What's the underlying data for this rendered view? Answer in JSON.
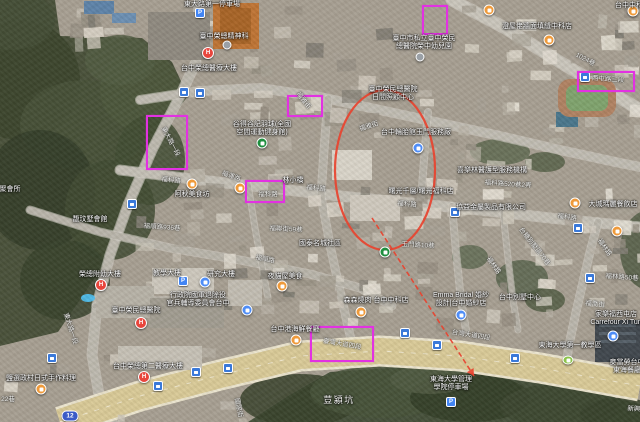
{
  "colors": {
    "annotation_magenta": "#e231e2",
    "route_red": "#e8432f",
    "label_white": "#ffffff",
    "boulevard_tan": "#d9ca97"
  },
  "route_shield": {
    "text": "12",
    "x": 70,
    "y": 416
  },
  "annotation_rects": [
    {
      "x": 146,
      "y": 115,
      "w": 42,
      "h": 55
    },
    {
      "x": 245,
      "y": 180,
      "w": 40,
      "h": 23
    },
    {
      "x": 422,
      "y": 5,
      "w": 26,
      "h": 30
    },
    {
      "x": 577,
      "y": 71,
      "w": 58,
      "h": 21
    },
    {
      "x": 287,
      "y": 95,
      "w": 36,
      "h": 22
    },
    {
      "x": 310,
      "y": 326,
      "w": 64,
      "h": 36
    }
  ],
  "route_annotation": {
    "ellipse": {
      "cx": 385,
      "cy": 170,
      "rx": 50,
      "ry": 80
    },
    "arrow_line": {
      "x1": 372,
      "y1": 218,
      "x2": 474,
      "y2": 376
    }
  },
  "labels": {
    "poi": [
      {
        "lines": [
          "東大路第一停車場"
        ],
        "x": 212,
        "y": 1
      },
      {
        "lines": [
          "臺中榮總精神科"
        ],
        "x": 224,
        "y": 33
      },
      {
        "lines": [
          "台中榮總醫療大樓"
        ],
        "x": 209,
        "y": 65
      },
      {
        "lines": [
          "臺中市私立臺中榮民",
          "總醫院榮中幼兒園"
        ],
        "x": 424,
        "y": 35
      },
      {
        "lines": [
          "臺中榮民總醫院",
          "日間照顧中心"
        ],
        "x": 393,
        "y": 86
      },
      {
        "lines": [
          "澄屋佬牆面填縫中科店"
        ],
        "x": 537,
        "y": 23
      },
      {
        "lines": [
          "台中中科"
        ],
        "x": 629,
        "y": 2
      },
      {
        "lines": [
          "台中輪胎館玉門服務廠"
        ],
        "x": 416,
        "y": 129
      },
      {
        "lines": [
          "谷得谷記羽球(全國",
          "空間運動健身館)"
        ],
        "x": 262,
        "y": 121
      },
      {
        "lines": [
          "喜樂林醫護型服務機構"
        ],
        "x": 492,
        "y": 167
      },
      {
        "lines": [
          "曙光千層/曙光福科店"
        ],
        "x": 421,
        "y": 188
      },
      {
        "lines": [
          "協益金屬製品有限公司"
        ],
        "x": 491,
        "y": 204
      },
      {
        "lines": [
          "大城瑪麗餐飲店"
        ],
        "x": 613,
        "y": 201
      },
      {
        "lines": [
          "阿秋美食坊"
        ],
        "x": 192,
        "y": 191
      },
      {
        "lines": [
          "林小橋"
        ],
        "x": 293,
        "y": 177
      },
      {
        "lines": [
          "馥玟墅會館"
        ],
        "x": 90,
        "y": 216
      },
      {
        "lines": [
          "聚會所"
        ],
        "x": 10,
        "y": 186
      },
      {
        "lines": [
          "國泰名城社區"
        ],
        "x": 320,
        "y": 240
      },
      {
        "lines": [
          "夜貓屋美食"
        ],
        "x": 285,
        "y": 273
      },
      {
        "lines": [
          "行政院國軍退除役",
          "官兵輔導委員會台中"
        ],
        "x": 198,
        "y": 292
      },
      {
        "lines": [
          "教學大樓"
        ],
        "x": 167,
        "y": 270
      },
      {
        "lines": [
          "研究大樓"
        ],
        "x": 221,
        "y": 271
      },
      {
        "lines": [
          "榮總附幼大樓"
        ],
        "x": 100,
        "y": 271
      },
      {
        "lines": [
          "臺中榮民總醫院"
        ],
        "x": 136,
        "y": 307
      },
      {
        "lines": [
          "台中榮總第二醫療大樓"
        ],
        "x": 148,
        "y": 363
      },
      {
        "lines": [
          "鹽選政村日式手作料理"
        ],
        "x": 41,
        "y": 375
      },
      {
        "lines": [
          "森森燒肉 台中中科店"
        ],
        "x": 376,
        "y": 297
      },
      {
        "lines": [
          "Emma Bridal 婚紗",
          "設計|台中婚紗店"
        ],
        "x": 461,
        "y": 292
      },
      {
        "lines": [
          "台中別墅中心"
        ],
        "x": 520,
        "y": 294
      },
      {
        "lines": [
          "台中港海鮮餐廳"
        ],
        "x": 295,
        "y": 326
      },
      {
        "lines": [
          "家樂福西屯店",
          "Carrefour Xi Tun"
        ],
        "x": 616,
        "y": 311
      },
      {
        "lines": [
          "麥當勞台中",
          "東海餐廳"
        ],
        "x": 627,
        "y": 359
      },
      {
        "lines": [
          "東海大學第一教學區"
        ],
        "x": 570,
        "y": 342
      },
      {
        "lines": [
          "東海大學管理",
          "學院停車場"
        ],
        "x": 451,
        "y": 376
      }
    ],
    "street": [
      {
        "text": "福雅街",
        "x": 369,
        "y": 123,
        "rot": -18
      },
      {
        "text": "福雅街",
        "x": 303,
        "y": 97,
        "rot": 52
      },
      {
        "text": "東大路一段",
        "x": 170,
        "y": 138,
        "rot": 62
      },
      {
        "text": "東大路一段",
        "x": 70,
        "y": 325,
        "rot": 72
      },
      {
        "text": "福科路",
        "x": 171,
        "y": 177,
        "rot": 6
      },
      {
        "text": "福科路",
        "x": 316,
        "y": 185,
        "rot": 6
      },
      {
        "text": "福科路",
        "x": 407,
        "y": 201,
        "rot": 5
      },
      {
        "text": "福科路",
        "x": 567,
        "y": 214,
        "rot": 8
      },
      {
        "text": "福科路",
        "x": 268,
        "y": 191,
        "rot": 0
      },
      {
        "text": "福科路520巷2弄",
        "x": 508,
        "y": 181,
        "rot": 4
      },
      {
        "text": "福運路",
        "x": 231,
        "y": 173,
        "rot": 20
      },
      {
        "text": "福順路936巷",
        "x": 162,
        "y": 224,
        "rot": 4
      },
      {
        "text": "福順路",
        "x": 265,
        "y": 256,
        "rot": 12
      },
      {
        "text": "福聯街59巷",
        "x": 286,
        "y": 226,
        "rot": 3
      },
      {
        "text": "玉門路10巷",
        "x": 418,
        "y": 242,
        "rot": 3
      },
      {
        "text": "福林路",
        "x": 493,
        "y": 262,
        "rot": 55
      },
      {
        "text": "台糖別墅區70巷",
        "x": 534,
        "y": 243,
        "rot": 52
      },
      {
        "text": "福林路",
        "x": 604,
        "y": 244,
        "rot": 55
      },
      {
        "text": "福林路50巷",
        "x": 622,
        "y": 274,
        "rot": 4
      },
      {
        "text": "福喬街",
        "x": 595,
        "y": 301,
        "rot": 6
      },
      {
        "text": "1024巷",
        "x": 585,
        "y": 56,
        "rot": 28
      },
      {
        "text": "西屯路三段",
        "x": 608,
        "y": 76,
        "rot": 4
      },
      {
        "text": "台灣大道四段",
        "x": 471,
        "y": 332,
        "rot": 9
      },
      {
        "text": "臺灣大道四段",
        "x": 342,
        "y": 341,
        "rot": 10
      },
      {
        "text": "國際街",
        "x": 238,
        "y": 404,
        "rot": 78
      },
      {
        "text": "新興路",
        "x": 637,
        "y": 406,
        "rot": 4
      },
      {
        "text": "22巷",
        "x": 8,
        "y": 396,
        "rot": 0
      }
    ],
    "area": [
      {
        "text": "荳潁坑",
        "x": 339,
        "y": 395
      }
    ]
  },
  "pins": [
    {
      "type": "restaurant",
      "x": 489,
      "y": 10
    },
    {
      "type": "restaurant",
      "x": 549,
      "y": 40
    },
    {
      "type": "restaurant",
      "x": 633,
      "y": 11
    },
    {
      "type": "restaurant",
      "x": 192,
      "y": 184
    },
    {
      "type": "restaurant",
      "x": 240,
      "y": 188
    },
    {
      "type": "restaurant",
      "x": 282,
      "y": 286
    },
    {
      "type": "restaurant",
      "x": 361,
      "y": 312
    },
    {
      "type": "restaurant",
      "x": 41,
      "y": 389
    },
    {
      "type": "restaurant",
      "x": 575,
      "y": 203
    },
    {
      "type": "restaurant",
      "x": 617,
      "y": 231
    },
    {
      "type": "restaurant",
      "x": 296,
      "y": 340
    },
    {
      "type": "hospital",
      "x": 208,
      "y": 53
    },
    {
      "type": "hospital",
      "x": 101,
      "y": 285
    },
    {
      "type": "hospital",
      "x": 141,
      "y": 323
    },
    {
      "type": "hospital",
      "x": 144,
      "y": 377
    },
    {
      "type": "transit",
      "x": 184,
      "y": 92
    },
    {
      "type": "transit",
      "x": 200,
      "y": 93
    },
    {
      "type": "transit",
      "x": 132,
      "y": 204
    },
    {
      "type": "transit",
      "x": 585,
      "y": 77
    },
    {
      "type": "transit",
      "x": 578,
      "y": 228
    },
    {
      "type": "transit",
      "x": 590,
      "y": 278
    },
    {
      "type": "transit",
      "x": 455,
      "y": 212
    },
    {
      "type": "transit",
      "x": 52,
      "y": 358
    },
    {
      "type": "transit",
      "x": 158,
      "y": 386
    },
    {
      "type": "transit",
      "x": 228,
      "y": 368
    },
    {
      "type": "transit",
      "x": 405,
      "y": 333
    },
    {
      "type": "transit",
      "x": 437,
      "y": 345
    },
    {
      "type": "transit",
      "x": 515,
      "y": 358
    },
    {
      "type": "transit",
      "x": 196,
      "y": 372
    },
    {
      "type": "parking",
      "x": 200,
      "y": 13
    },
    {
      "type": "parking",
      "x": 183,
      "y": 281
    },
    {
      "type": "parking",
      "x": 451,
      "y": 402
    },
    {
      "type": "shop",
      "x": 418,
      "y": 148
    },
    {
      "type": "shop",
      "x": 461,
      "y": 315
    },
    {
      "type": "shop",
      "x": 613,
      "y": 336
    },
    {
      "type": "shop",
      "x": 247,
      "y": 310
    },
    {
      "type": "shop",
      "x": 205,
      "y": 282
    },
    {
      "type": "park",
      "x": 262,
      "y": 143
    },
    {
      "type": "park",
      "x": 385,
      "y": 252
    },
    {
      "type": "leaf",
      "x": 568,
      "y": 360
    },
    {
      "type": "generic",
      "x": 227,
      "y": 45
    },
    {
      "type": "generic",
      "x": 420,
      "y": 57
    }
  ]
}
